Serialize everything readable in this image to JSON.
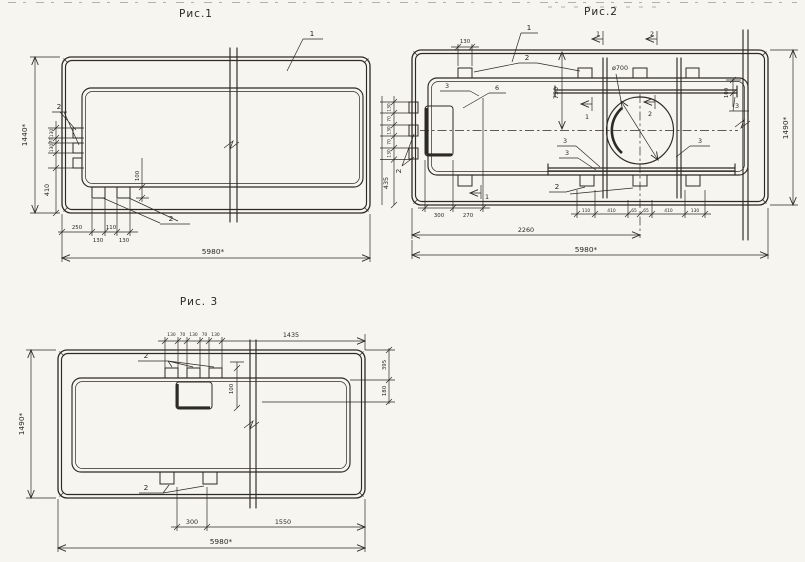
{
  "page": {
    "paper_color": "#f6f5ef",
    "ink_color": "#2d2a23"
  },
  "fig1": {
    "title": "Рис.1",
    "callout_1": "1",
    "callout_2_left": "2",
    "callout_2_bottom": "2",
    "dim_height": "1440*",
    "dim_length": "5980*",
    "left_chain": [
      "130",
      "70",
      "130"
    ],
    "dim_410": "410",
    "dim_100": "100",
    "dim_250": "250",
    "dim_110": "110",
    "dim_130a": "130",
    "dim_130b": "130"
  },
  "fig2": {
    "title": "Рис.2",
    "callout_1": "1",
    "callout_2_tabs": "2",
    "callout_2_left": "2",
    "callout_2_bottom": "2",
    "callout_3": "3",
    "callout_6": "6",
    "section_1": "1",
    "section_2": "2",
    "dim_tab_130": "130",
    "dim_hole": "ø700",
    "dim_750": "750",
    "dim_100": "100",
    "dim_height": "1490*",
    "dim_435": "435",
    "left_chain": [
      "130",
      "70",
      "130",
      "70",
      "130"
    ],
    "mid_chain": [
      "110",
      "410",
      "65",
      "65",
      "410",
      "130"
    ],
    "dim_300": "300",
    "dim_270": "270",
    "dim_2260": "2260",
    "dim_length": "5980*"
  },
  "fig3": {
    "title": "Рис. 3",
    "callout_2_top": "2",
    "callout_2_bottom": "2",
    "top_chain": [
      "130",
      "70",
      "130",
      "70",
      "130"
    ],
    "dim_1435": "1435",
    "dim_395": "395",
    "dim_180": "180",
    "dim_100": "100",
    "dim_height": "1490*",
    "dim_300": "300",
    "dim_1550": "1550",
    "dim_length": "5980*"
  }
}
